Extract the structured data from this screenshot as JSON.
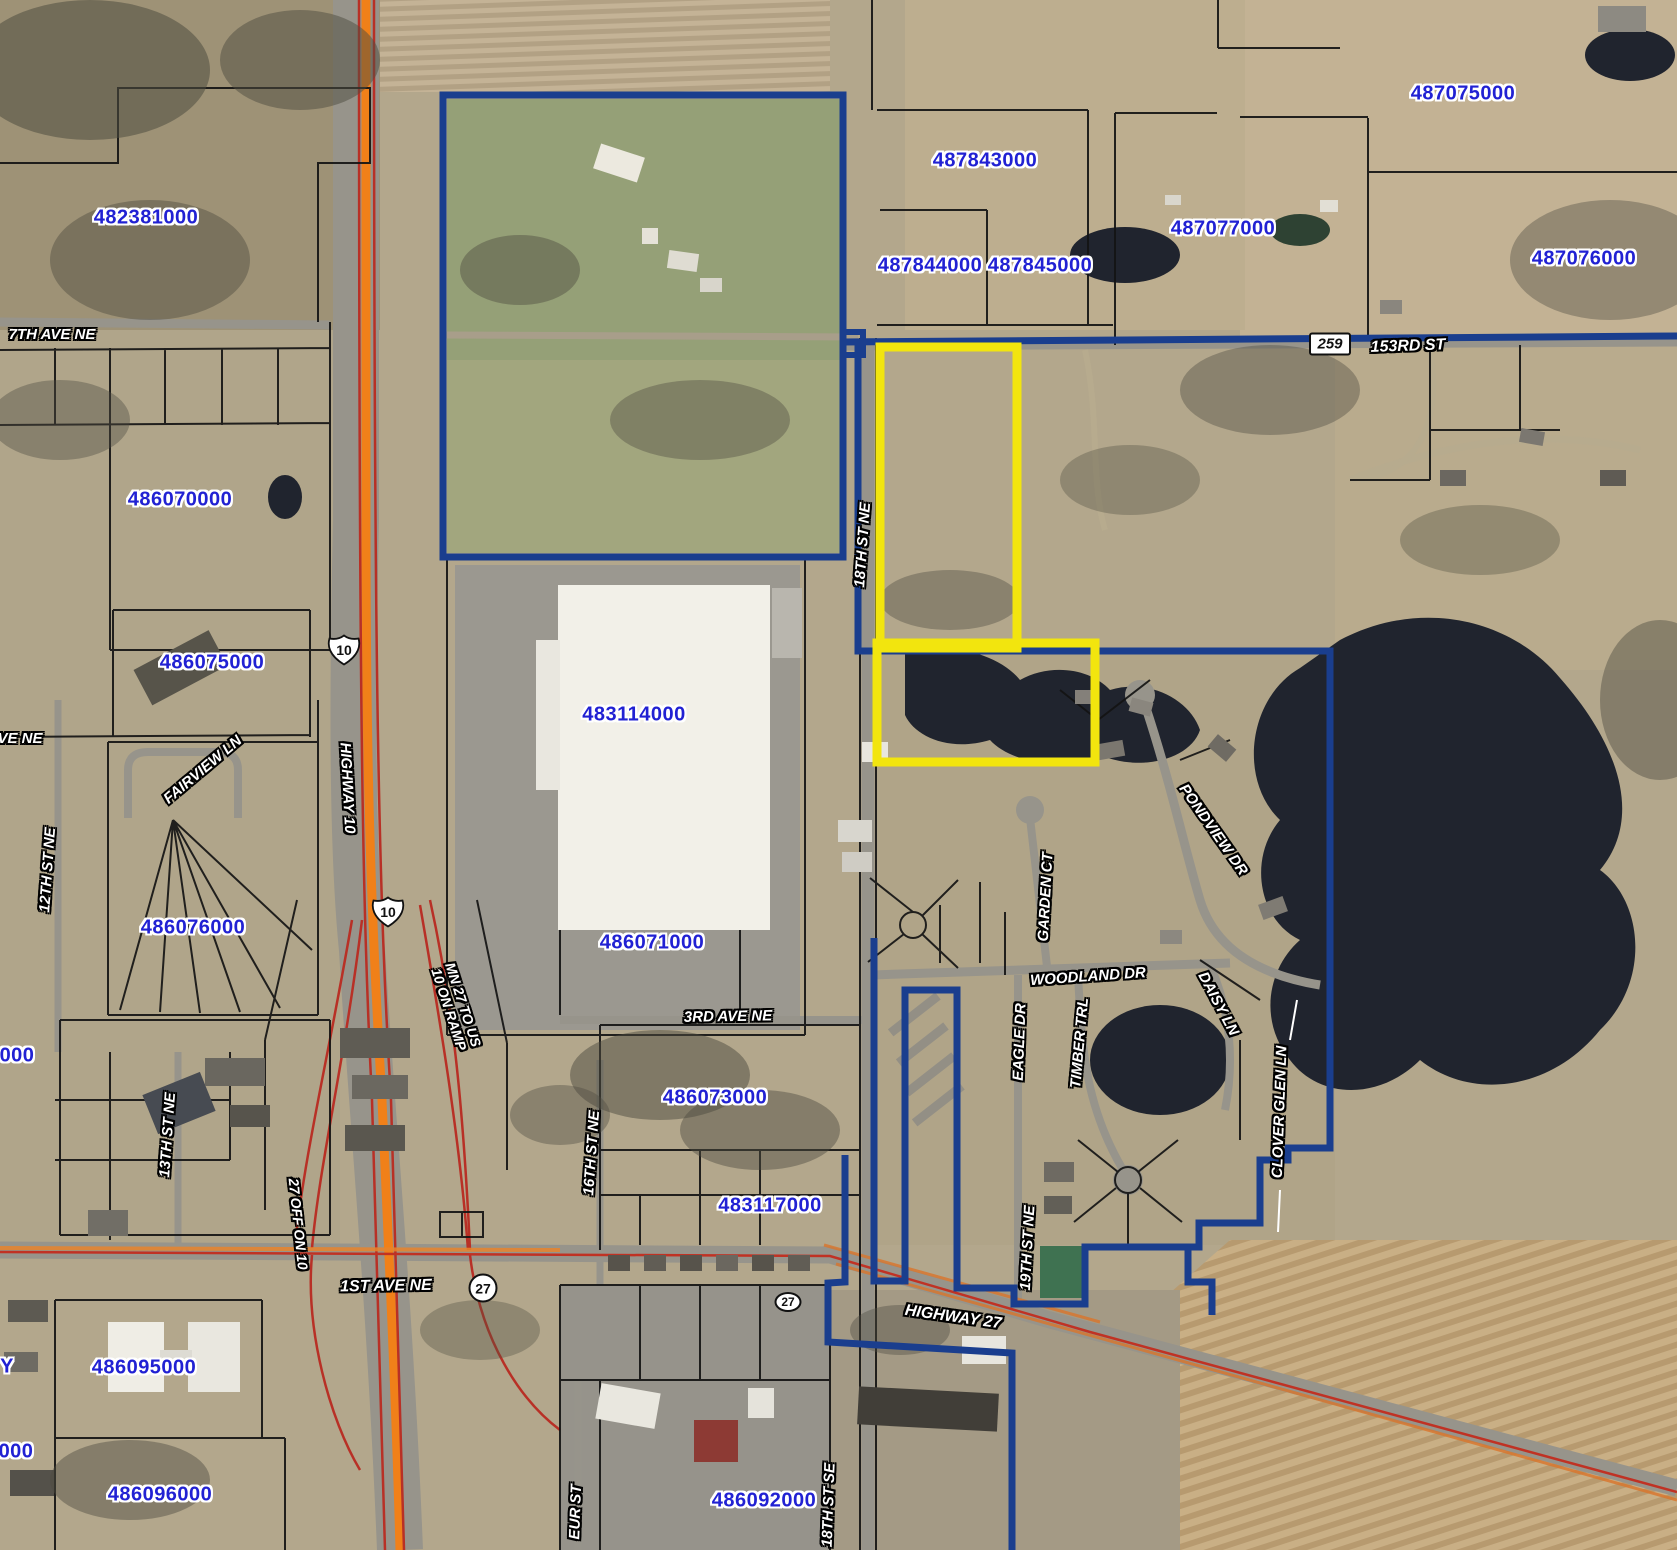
{
  "map": {
    "width": 1677,
    "height": 1550,
    "colors": {
      "parcel_id_text": "#2121d3",
      "subject_highlight": "#f2e50e",
      "boundary_navy": "#1a3e8e",
      "highway_orange": "#f08019",
      "highway_red": "#b83026",
      "parcel_line": "#141414",
      "water": "#20242e",
      "field_green": "#95a077",
      "aerial_tan": "#b3a78c"
    },
    "parcel_labels": [
      {
        "id": "482381000",
        "x": 146,
        "y": 218
      },
      {
        "id": "486070000",
        "x": 180,
        "y": 500
      },
      {
        "id": "486075000",
        "x": 212,
        "y": 663
      },
      {
        "id": "486076000",
        "x": 193,
        "y": 928
      },
      {
        "id": "486095000",
        "x": 144,
        "y": 1368
      },
      {
        "id": "486096000",
        "x": 160,
        "y": 1495
      },
      {
        "id": "483114000",
        "x": 634,
        "y": 715
      },
      {
        "id": "486071000",
        "x": 652,
        "y": 943
      },
      {
        "id": "486073000",
        "x": 715,
        "y": 1098
      },
      {
        "id": "483117000",
        "x": 770,
        "y": 1206
      },
      {
        "id": "486092000",
        "x": 764,
        "y": 1501
      },
      {
        "id": "487843000",
        "x": 985,
        "y": 161
      },
      {
        "id": "487844000",
        "x": 930,
        "y": 266
      },
      {
        "id": "487845000",
        "x": 1040,
        "y": 266
      },
      {
        "id": "487077000",
        "x": 1223,
        "y": 229
      },
      {
        "id": "487075000",
        "x": 1463,
        "y": 94
      },
      {
        "id": "487076000",
        "x": 1584,
        "y": 259
      },
      {
        "id": "000",
        "x": 17,
        "y": 1056
      },
      {
        "id": "Y",
        "x": 7,
        "y": 1367
      },
      {
        "id": "000",
        "x": 16,
        "y": 1452
      }
    ],
    "street_labels": [
      {
        "text": "7TH AVE NE",
        "x": 52,
        "y": 335,
        "rot": 0,
        "size": 15
      },
      {
        "text": "VE NE",
        "x": 20,
        "y": 739,
        "rot": 0,
        "size": 15
      },
      {
        "text": "153RD ST",
        "x": 1408,
        "y": 347,
        "rot": -2,
        "size": 16
      },
      {
        "text": "18TH ST NE",
        "x": 863,
        "y": 545,
        "rot": -86,
        "size": 15
      },
      {
        "text": "FAIRVIEW LN",
        "x": 203,
        "y": 770,
        "rot": -40,
        "size": 15
      },
      {
        "text": "12TH ST NE",
        "x": 48,
        "y": 870,
        "rot": -86,
        "size": 15
      },
      {
        "text": "13TH ST NE",
        "x": 168,
        "y": 1135,
        "rot": -86,
        "size": 15
      },
      {
        "text": "16TH ST NE",
        "x": 592,
        "y": 1153,
        "rot": -86,
        "size": 15
      },
      {
        "text": "HIGHWAY 10",
        "x": 347,
        "y": 788,
        "rot": 87,
        "size": 15
      },
      {
        "text": "MN 27 TO US\n10 ON RAMP",
        "x": 456,
        "y": 1007,
        "rot": 72,
        "size": 14
      },
      {
        "text": "27 OFF ON 10",
        "x": 298,
        "y": 1224,
        "rot": 84,
        "size": 14
      },
      {
        "text": "1ST AVE NE",
        "x": 386,
        "y": 1287,
        "rot": -1,
        "size": 16
      },
      {
        "text": "HIGHWAY 27",
        "x": 953,
        "y": 1318,
        "rot": 8,
        "size": 16
      },
      {
        "text": "3RD AVE NE",
        "x": 728,
        "y": 1017,
        "rot": -1,
        "size": 15
      },
      {
        "text": "WOODLAND DR",
        "x": 1088,
        "y": 977,
        "rot": -4,
        "size": 15
      },
      {
        "text": "GARDEN CT",
        "x": 1046,
        "y": 897,
        "rot": -87,
        "size": 15
      },
      {
        "text": "EAGLE DR",
        "x": 1020,
        "y": 1042,
        "rot": -88,
        "size": 15
      },
      {
        "text": "TIMBER TRL",
        "x": 1080,
        "y": 1043,
        "rot": -85,
        "size": 15
      },
      {
        "text": "PONDVIEW DR",
        "x": 1213,
        "y": 830,
        "rot": 55,
        "size": 15
      },
      {
        "text": "DAISY LN",
        "x": 1218,
        "y": 1004,
        "rot": 62,
        "size": 15
      },
      {
        "text": "CLOVER GLEN LN",
        "x": 1280,
        "y": 1112,
        "rot": -88,
        "size": 15
      },
      {
        "text": "19TH ST NE",
        "x": 1028,
        "y": 1248,
        "rot": -87,
        "size": 15
      },
      {
        "text": "18TH ST SE",
        "x": 829,
        "y": 1505,
        "rot": -88,
        "size": 15
      },
      {
        "text": "EUR ST",
        "x": 576,
        "y": 1512,
        "rot": -88,
        "size": 15
      }
    ],
    "route_shields": [
      {
        "type": "us",
        "text": "10",
        "x": 344,
        "y": 650
      },
      {
        "type": "us",
        "text": "10",
        "x": 388,
        "y": 912
      },
      {
        "type": "circle",
        "text": "27",
        "x": 483,
        "y": 1288
      },
      {
        "type": "oval",
        "text": "27",
        "x": 788,
        "y": 1302
      },
      {
        "type": "box",
        "text": "259",
        "x": 1330,
        "y": 344
      }
    ],
    "highlight": {
      "yellow_boxes": [
        {
          "x": 880,
          "y": 347,
          "w": 137,
          "h": 301
        },
        {
          "x": 877,
          "y": 643,
          "w": 218,
          "h": 119
        }
      ],
      "navy_rect": {
        "x": 443,
        "y": 95,
        "w": 400,
        "h": 462
      },
      "navy_notch": [
        [
          843,
          332
        ],
        [
          863,
          332
        ],
        [
          863,
          355
        ],
        [
          843,
          355
        ]
      ],
      "navy_segments": [
        [
          [
            843,
            342
          ],
          [
            1677,
            336
          ]
        ],
        [
          [
            858,
            342
          ],
          [
            858,
            651
          ],
          [
            1330,
            651
          ],
          [
            1330,
            1148
          ],
          [
            1288,
            1148
          ],
          [
            1288,
            1160
          ],
          [
            1260,
            1160
          ],
          [
            1260,
            1223
          ],
          [
            1199,
            1223
          ],
          [
            1199,
            1247
          ],
          [
            1085,
            1247
          ],
          [
            1085,
            1304
          ],
          [
            1014,
            1304
          ],
          [
            1014,
            1288
          ],
          [
            957,
            1288
          ],
          [
            957,
            990
          ],
          [
            905,
            990
          ],
          [
            905,
            1281
          ],
          [
            874,
            1281
          ],
          [
            874,
            938
          ]
        ],
        [
          [
            845,
            1155
          ],
          [
            845,
            1282
          ],
          [
            828,
            1283
          ],
          [
            828,
            1342
          ],
          [
            1012,
            1353
          ],
          [
            1012,
            1550
          ]
        ],
        [
          [
            1188,
            1248
          ],
          [
            1188,
            1282
          ],
          [
            1212,
            1282
          ],
          [
            1212,
            1315
          ]
        ]
      ]
    }
  }
}
